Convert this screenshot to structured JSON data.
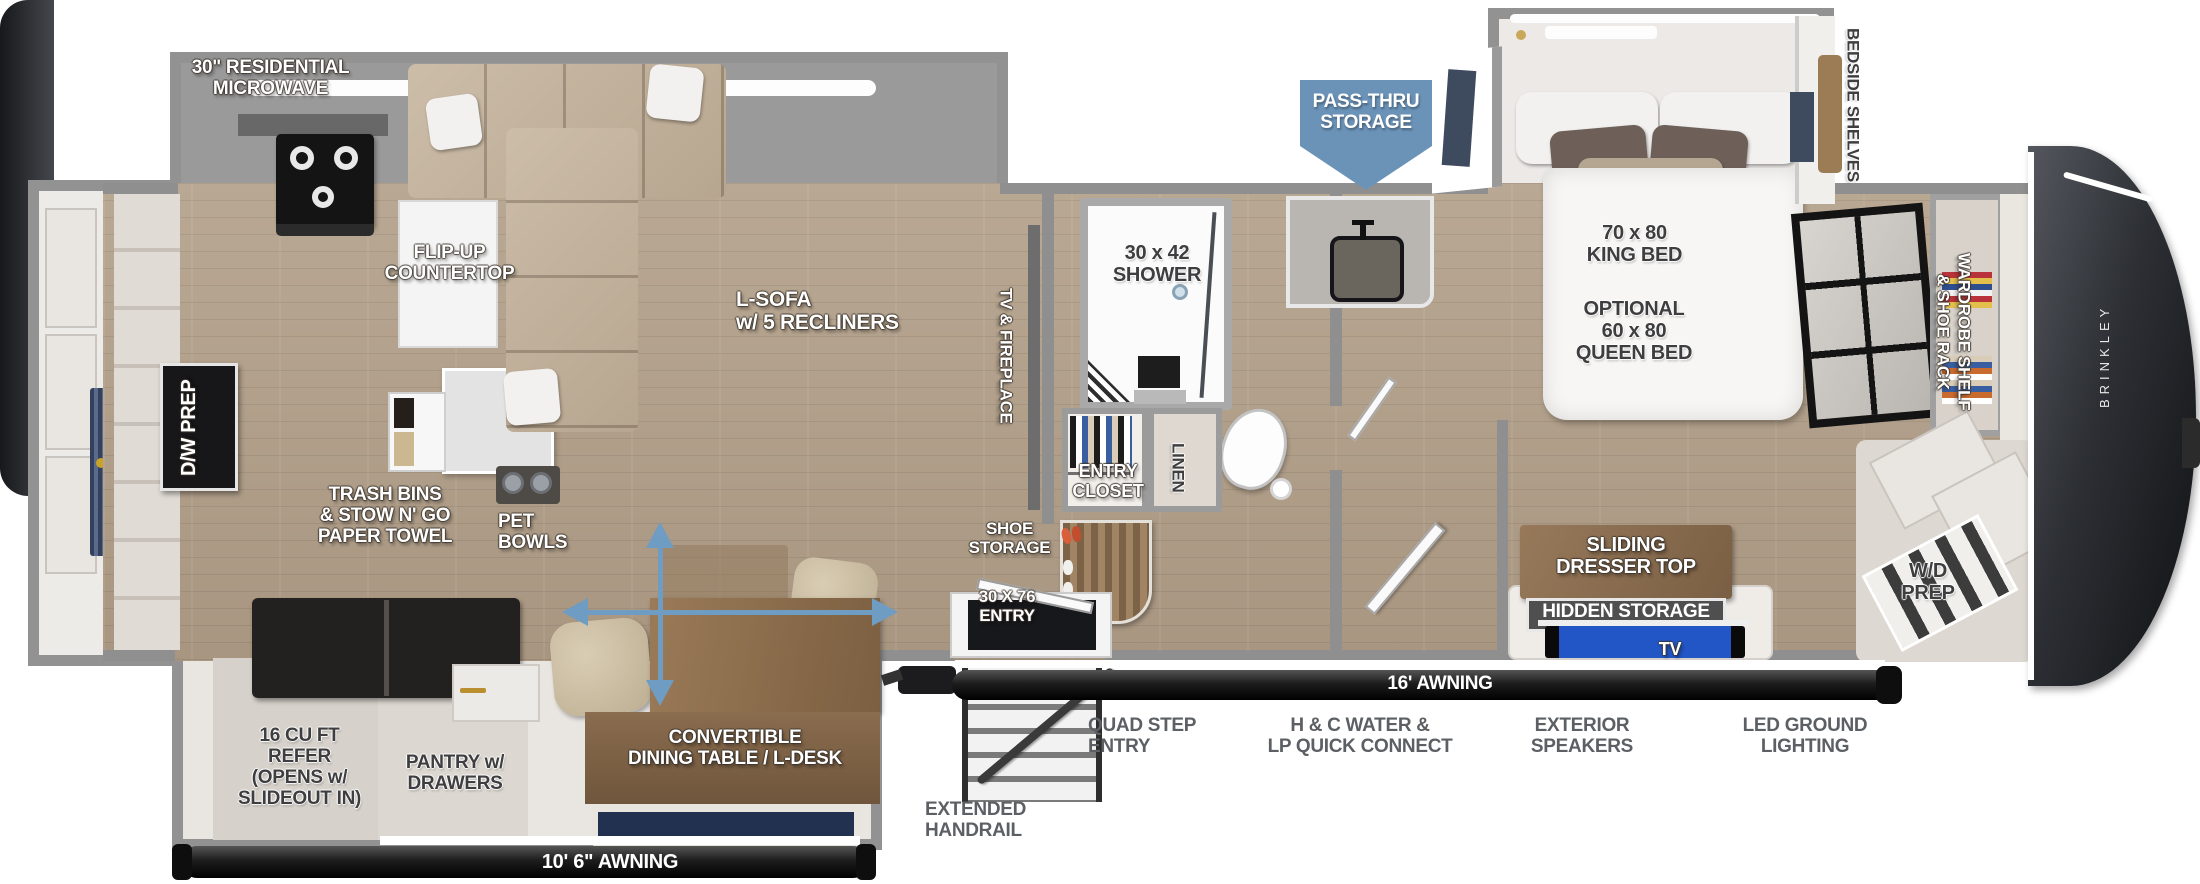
{
  "colors": {
    "wall_gray": "#8f8f8f",
    "roof_gray": "#9a9a9a",
    "floor_light": "#b9a893",
    "floor_dark": "#a89681",
    "awning_black": "#1c1c1c",
    "sign_black": "#17171a",
    "sign_wood": "#8a6c4e",
    "sign_gray": "#4f4f4f",
    "pass_thru_blue": "#6b93b8",
    "arrow_blue": "#6f9cc2",
    "sofa_beige": "#c3b4a1",
    "front_cap": "#26292e",
    "window_slate": "#3e4a5e",
    "tv_screen": "#2256c7"
  },
  "labels": {
    "microwave": "30\" RESIDENTIAL\nMICROWAVE",
    "flip_up_countertop": "FLIP-UP\nCOUNTERTOP",
    "l_sofa": "L-SOFA\nw/ 5 RECLINERS",
    "tv_fireplace": "TV & FIREPLACE",
    "dw_prep": "D/W PREP",
    "trash_bins": "TRASH BINS\n& STOW N' GO\nPAPER TOWEL",
    "pet_bowls": "PET\nBOWLS",
    "refer": "16 CU FT\nREFER\n(OPENS w/\nSLIDEOUT IN)",
    "pantry": "PANTRY w/\nDRAWERS",
    "dining_table": "CONVERTIBLE\nDINING TABLE / L-DESK",
    "awning_rear": "10' 6\" AWNING",
    "shower": "30 x 42\nSHOWER",
    "entry_closet": "ENTRY\nCLOSET",
    "linen": "LINEN",
    "shoe_storage": "SHOE\nSTORAGE",
    "entry_door": "30 X 76\nENTRY",
    "extended_handrail": "EXTENDED\nHANDRAIL",
    "quad_step_entry": "QUAD STEP\nENTRY",
    "water_lp": "H & C WATER &\nLP QUICK CONNECT",
    "awning_main": "16' AWNING",
    "pass_thru": "PASS-THRU\nSTORAGE",
    "bedside_shelves": "BEDSIDE SHELVES",
    "king_bed": "70 x 80\nKING BED",
    "queen_bed": "OPTIONAL\n60 x 80\nQUEEN BED",
    "wardrobe": "WARDROBE SHELF\n& SHOE RACK",
    "sliding_dresser": "SLIDING\nDRESSER TOP",
    "hidden_storage": "HIDDEN STORAGE",
    "tv": "TV",
    "wd_prep": "W/D\nPREP",
    "exterior_speakers": "EXTERIOR\nSPEAKERS",
    "led_lighting": "LED GROUND\nLIGHTING",
    "brand": "BRINKLEY"
  }
}
